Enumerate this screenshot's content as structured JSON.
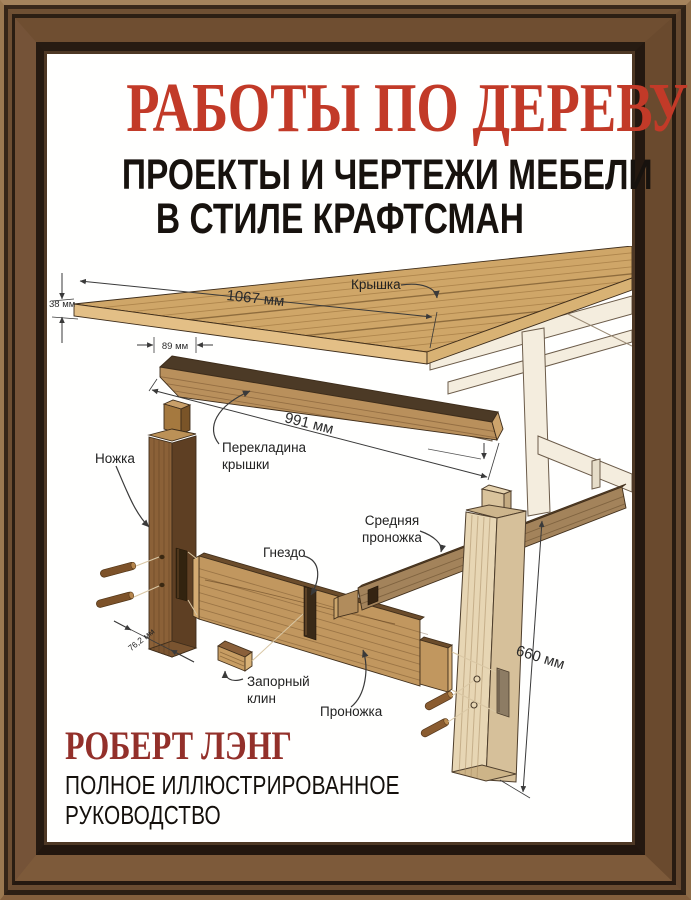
{
  "book_cover": {
    "title": "РАБОТЫ ПО ДЕРЕВУ",
    "subtitle": [
      "ПРОЕКТЫ И ЧЕРТЕЖИ МЕБЕЛИ",
      "В СТИЛЕ КРАФТСМАН"
    ],
    "author": "РОБЕРТ ЛЭНГ",
    "tagline": [
      "ПОЛНОЕ ИЛЛЮСТРИРОВАННОЕ",
      "РУКОВОДСТВО"
    ],
    "colors": {
      "title_red": "#c23a28",
      "author_maroon": "#93302a",
      "frame_brown": "#7d5a3a"
    }
  },
  "diagram": {
    "part_labels": {
      "tabletop": "Крышка",
      "top_rail_line1": "Перекладина",
      "top_rail_line2": "крышки",
      "leg": "Ножка",
      "mortise": "Гнездо",
      "middle_stretcher_line1": "Средняя",
      "middle_stretcher_line2": "проножка",
      "wedge_line1": "Запорный",
      "wedge_line2": "клин",
      "stretcher": "Проножка"
    },
    "dimensions": {
      "top_thickness": "38 мм",
      "top_length": "1067 мм",
      "rail_width": "89 мм",
      "rail_length": "991 мм",
      "leg_height": "660 мм",
      "leg_thickness": "76,2 мм"
    }
  }
}
